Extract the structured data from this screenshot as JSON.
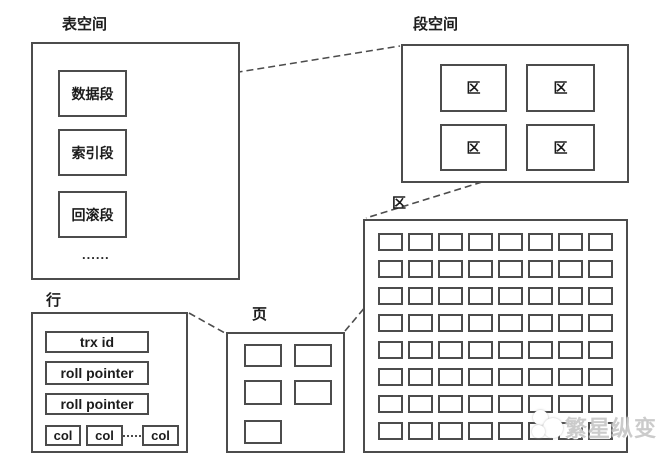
{
  "diagram": {
    "tablespace": {
      "label": "表空间",
      "segments": [
        "数据段",
        "索引段",
        "回滚段"
      ],
      "ellipsis": "......"
    },
    "segment_space": {
      "label": "段空间",
      "extents": [
        "区",
        "区",
        "区",
        "区"
      ]
    },
    "extent": {
      "label": "区",
      "grid_rows": 8,
      "grid_cols": 8
    },
    "page": {
      "label": "页",
      "block_count": 5
    },
    "row": {
      "label": "行",
      "fields": [
        "trx id",
        "roll pointer",
        "roll pointer"
      ],
      "cols": [
        "col",
        "col",
        "col"
      ]
    },
    "watermark": {
      "text": "繁星纵变"
    }
  },
  "colors": {
    "line": "#4c4c4c",
    "text": "#1c1c1c",
    "background": "#ffffff",
    "watermark_text": "#b9b9b9"
  }
}
